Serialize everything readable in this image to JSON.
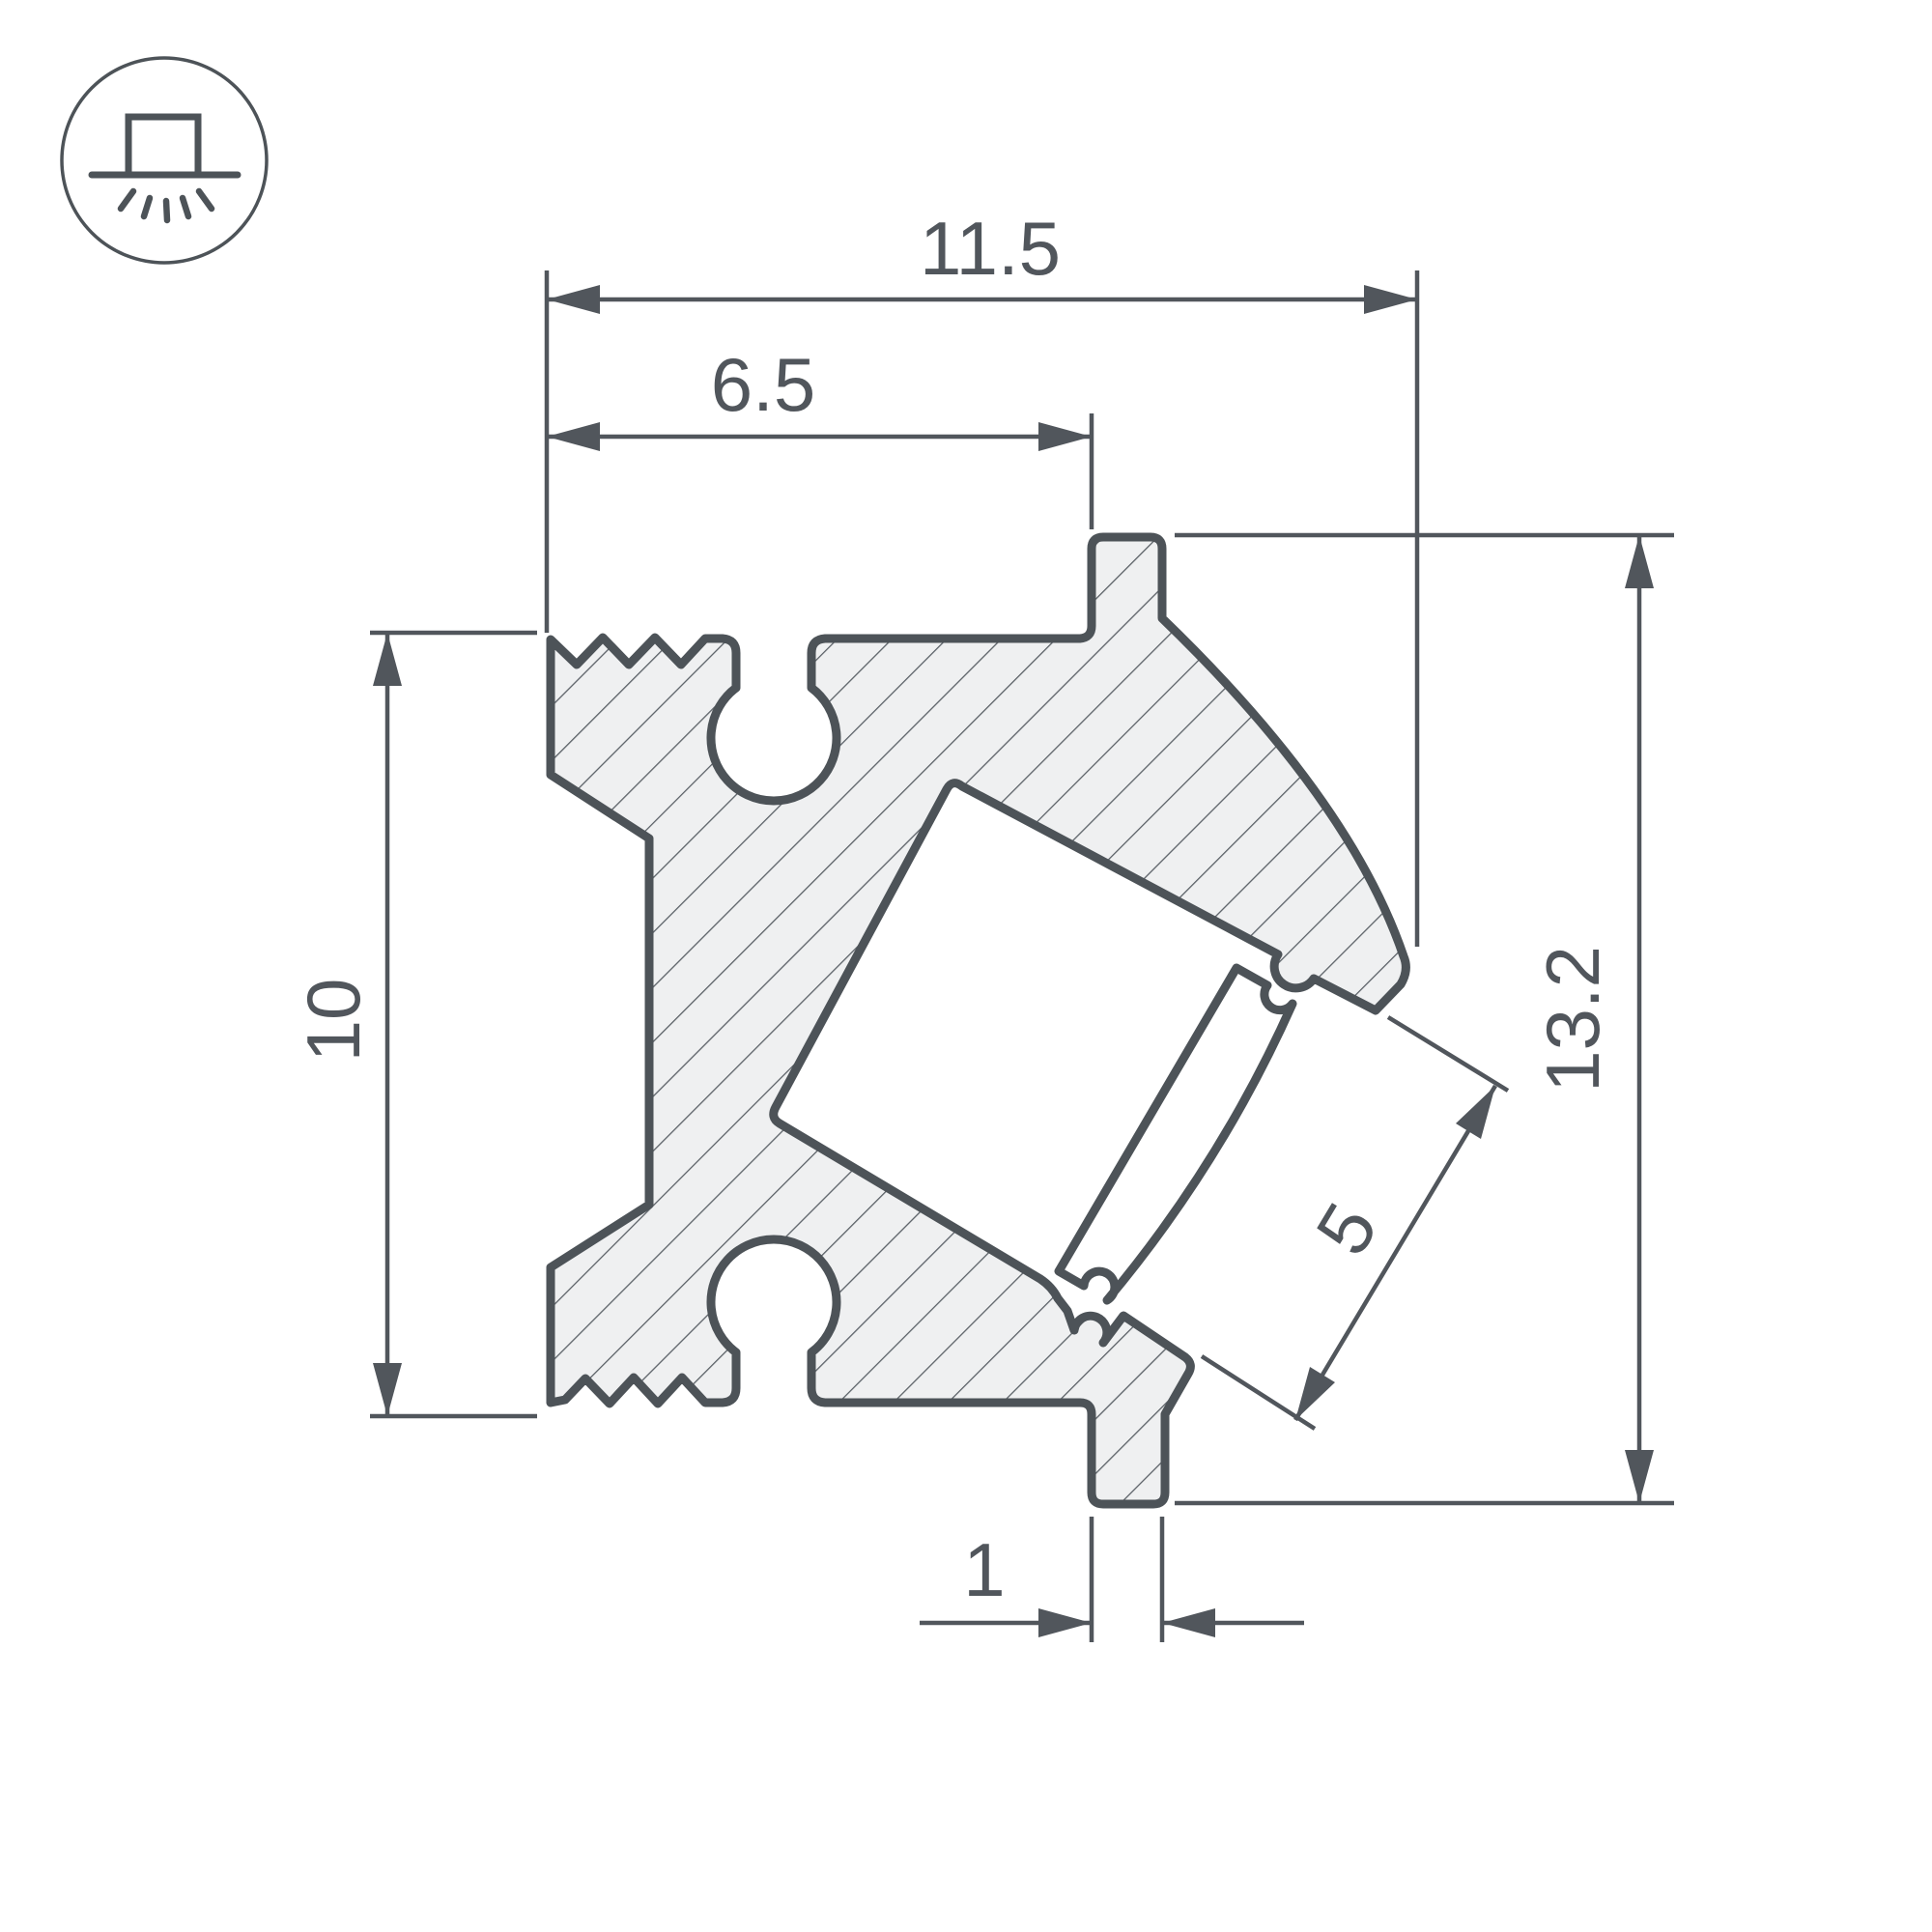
{
  "drawing": {
    "title": "led-profile-cross-section",
    "icon": "surface-mounted-luminaire",
    "labels": {
      "total_width": "11.5",
      "inner_width": "6.5",
      "left_height": "10",
      "total_height": "13.2",
      "led_strip_width": "5",
      "foot_width": "1"
    },
    "colors": {
      "line": "#4d5358",
      "dim_line": "#51565c",
      "profile_fill": "#eff0f1",
      "hatch_line": "#5b6167",
      "background": "#ffffff"
    }
  }
}
